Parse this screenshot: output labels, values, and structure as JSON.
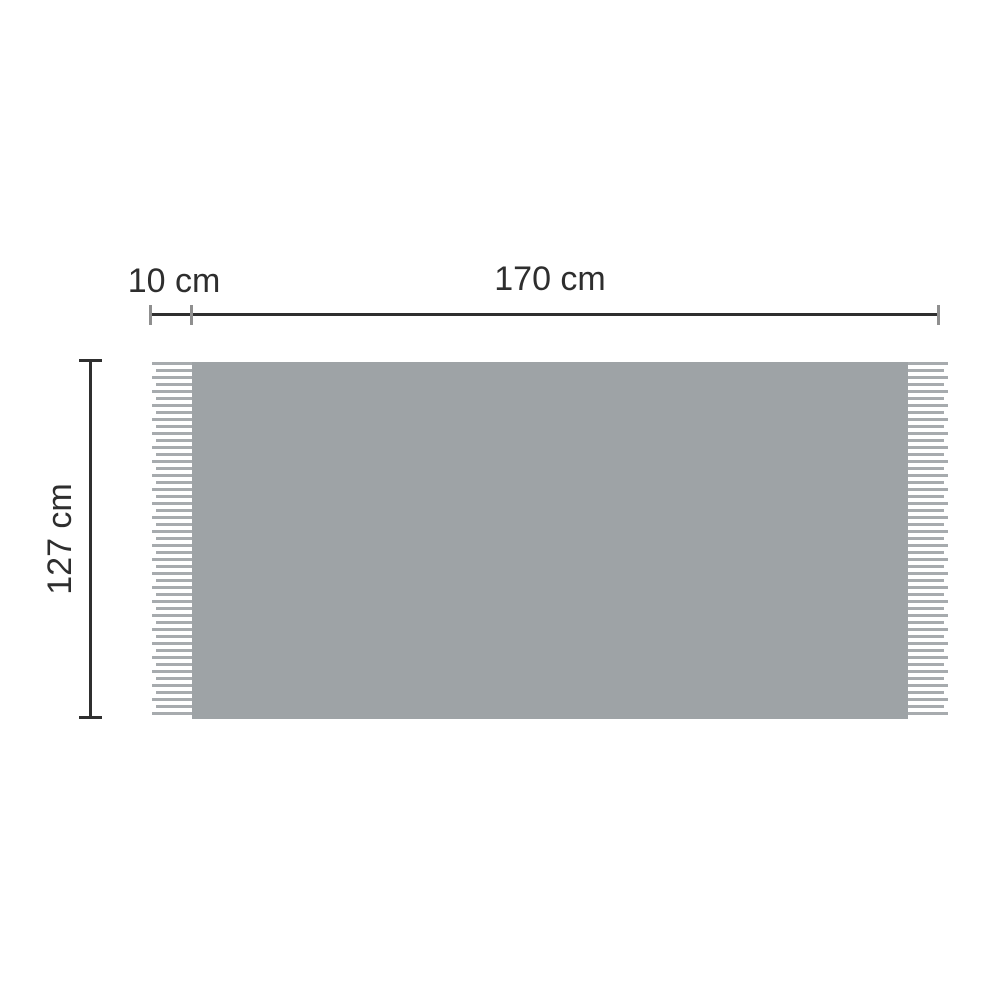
{
  "diagram": {
    "dimensions": {
      "fringe_width": "10 cm",
      "blanket_width": "170 cm",
      "blanket_height": "127 cm"
    }
  },
  "colors": {
    "background": "#ffffff",
    "blanket_fill": "#9ea3a6",
    "fringe_thread": "#a7abae",
    "dimension_line": "#2f2f2f",
    "tick": "#8f8f8f",
    "text": "#2e2e2e"
  }
}
